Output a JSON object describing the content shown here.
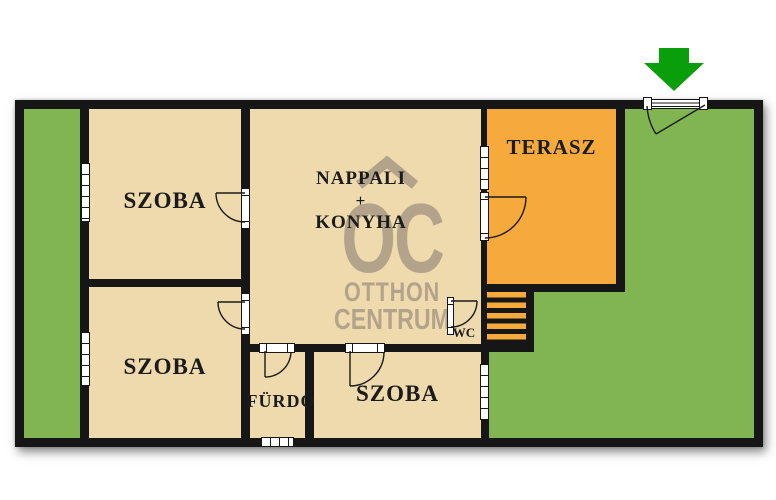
{
  "plan": {
    "rooms": {
      "szoba_top_left": {
        "label": "SZOBA"
      },
      "szoba_bottom_left": {
        "label": "SZOBA"
      },
      "szoba_bottom_right": {
        "label": "SZOBA"
      },
      "nappali_konyha": {
        "line1": "NAPPALI",
        "line2": "+",
        "line3": "KONYHA"
      },
      "terasz": {
        "label": "TERASZ"
      },
      "furdo": {
        "label": "FÜRDŐ"
      },
      "wc": {
        "label": "WC"
      }
    }
  },
  "watermark": {
    "logo": "OC",
    "line1": "OTTHON",
    "line2": "CENTRUM"
  },
  "colors": {
    "grass": "#80b551",
    "room": "#eedaad",
    "terrace": "#f6aa3b",
    "wall": "#161616",
    "arrow": "#0b9e0b",
    "wm": "#b4a38b"
  }
}
